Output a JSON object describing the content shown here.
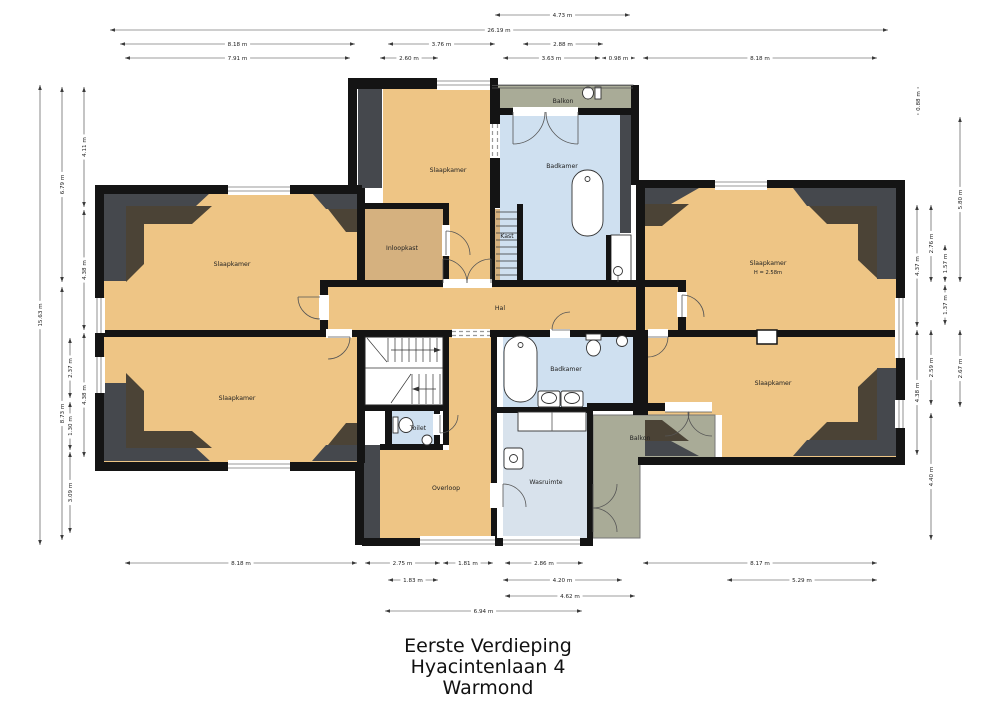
{
  "title": {
    "line1": "Eerste Verdieping",
    "line2": "Hyacintenlaan 4",
    "line3": "Warmond"
  },
  "rooms": [
    {
      "id": "slaapkamer-tl",
      "label": "Slaapkamer",
      "x": 232,
      "y": 266
    },
    {
      "id": "slaapkamer-bl",
      "label": "Slaapkamer",
      "x": 237,
      "y": 400
    },
    {
      "id": "slaapkamer-tc",
      "label": "Slaapkamer",
      "x": 448,
      "y": 172
    },
    {
      "id": "inloopkast",
      "label": "Inloopkast",
      "x": 402,
      "y": 250
    },
    {
      "id": "kast",
      "label": "Kast",
      "x": 507,
      "y": 238
    },
    {
      "id": "badkamer-top",
      "label": "Badkamer",
      "x": 562,
      "y": 168
    },
    {
      "id": "balkon-top",
      "label": "Balkon",
      "x": 563,
      "y": 103
    },
    {
      "id": "slaapkamer-tr",
      "label": "Slaapkamer",
      "x": 768,
      "y": 265,
      "sub": "H = 2.58m"
    },
    {
      "id": "slaapkamer-br",
      "label": "Slaapkamer",
      "x": 773,
      "y": 385
    },
    {
      "id": "hal",
      "label": "Hal",
      "x": 500,
      "y": 310
    },
    {
      "id": "toilet",
      "label": "Toilet",
      "x": 418,
      "y": 430
    },
    {
      "id": "overloop",
      "label": "Overloop",
      "x": 446,
      "y": 490
    },
    {
      "id": "badkamer-bottom",
      "label": "Badkamer",
      "x": 566,
      "y": 371
    },
    {
      "id": "wasruimte",
      "label": "Wasruimte",
      "x": 546,
      "y": 484
    },
    {
      "id": "balkon-bottom",
      "label": "Balkon",
      "x": 640,
      "y": 440
    }
  ],
  "dimensions": {
    "horizontal": [
      {
        "x1": 495,
        "x2": 630,
        "y": 15,
        "label": "4.73 m"
      },
      {
        "x1": 110,
        "x2": 888,
        "y": 30,
        "label": "26.19 m"
      },
      {
        "x1": 120,
        "x2": 355,
        "y": 44,
        "label": "8.18 m"
      },
      {
        "x1": 388,
        "x2": 495,
        "y": 44,
        "label": "3.76 m"
      },
      {
        "x1": 523,
        "x2": 603,
        "y": 44,
        "label": "2.88 m"
      },
      {
        "x1": 125,
        "x2": 350,
        "y": 58,
        "label": "7.91 m"
      },
      {
        "x1": 380,
        "x2": 438,
        "y": 58,
        "label": "2.60 m"
      },
      {
        "x1": 503,
        "x2": 600,
        "y": 58,
        "label": "3.63 m"
      },
      {
        "x1": 602,
        "x2": 635,
        "y": 58,
        "label": "0.98 m"
      },
      {
        "x1": 643,
        "x2": 877,
        "y": 58,
        "label": "8.18 m"
      },
      {
        "x1": 125,
        "x2": 357,
        "y": 563,
        "label": "8.18 m"
      },
      {
        "x1": 365,
        "x2": 440,
        "y": 563,
        "label": "2.75 m"
      },
      {
        "x1": 443,
        "x2": 493,
        "y": 563,
        "label": "1.81 m"
      },
      {
        "x1": 505,
        "x2": 583,
        "y": 563,
        "label": "2.86 m"
      },
      {
        "x1": 643,
        "x2": 877,
        "y": 563,
        "label": "8.17 m"
      },
      {
        "x1": 388,
        "x2": 438,
        "y": 580,
        "label": "1.83 m"
      },
      {
        "x1": 503,
        "x2": 622,
        "y": 580,
        "label": "4.20 m"
      },
      {
        "x1": 727,
        "x2": 877,
        "y": 580,
        "label": "5.29 m"
      },
      {
        "x1": 505,
        "x2": 635,
        "y": 596,
        "label": "4.62 m"
      },
      {
        "x1": 385,
        "x2": 582,
        "y": 611,
        "label": "6.94 m"
      }
    ],
    "vertical": [
      {
        "x": 40,
        "y1": 85,
        "y2": 545,
        "label": "15.63 m"
      },
      {
        "x": 62,
        "y1": 87,
        "y2": 282,
        "label": "6.79 m"
      },
      {
        "x": 62,
        "y1": 287,
        "y2": 540,
        "label": "8.73 m"
      },
      {
        "x": 84,
        "y1": 87,
        "y2": 207,
        "label": "4.11 m"
      },
      {
        "x": 84,
        "y1": 210,
        "y2": 330,
        "label": "4.38 m"
      },
      {
        "x": 70,
        "y1": 338,
        "y2": 398,
        "label": "2.37 m"
      },
      {
        "x": 70,
        "y1": 402,
        "y2": 450,
        "label": "1.30 m"
      },
      {
        "x": 70,
        "y1": 452,
        "y2": 533,
        "label": "3.09 m"
      },
      {
        "x": 84,
        "y1": 333,
        "y2": 457,
        "label": "4.38 m"
      },
      {
        "x": 918,
        "y1": 87,
        "y2": 115,
        "label": "0.88 m"
      },
      {
        "x": 960,
        "y1": 117,
        "y2": 282,
        "label": "5.80 m"
      },
      {
        "x": 917,
        "y1": 205,
        "y2": 327,
        "label": "4.37 m"
      },
      {
        "x": 931,
        "y1": 205,
        "y2": 282,
        "label": "2.76 m"
      },
      {
        "x": 945,
        "y1": 245,
        "y2": 282,
        "label": "1.57 m"
      },
      {
        "x": 945,
        "y1": 285,
        "y2": 325,
        "label": "1.37 m"
      },
      {
        "x": 917,
        "y1": 330,
        "y2": 455,
        "label": "4.38 m"
      },
      {
        "x": 931,
        "y1": 330,
        "y2": 405,
        "label": "2.59 m"
      },
      {
        "x": 960,
        "y1": 330,
        "y2": 407,
        "label": "2.67 m"
      },
      {
        "x": 931,
        "y1": 413,
        "y2": 540,
        "label": "4.40 m"
      }
    ]
  },
  "colors": {
    "floor_main": "#eec585",
    "floor_closet": "#d5b17f",
    "floor_wet": "#cfe0f0",
    "floor_laundry": "#d8e2ec",
    "balcony": "#a9ab97",
    "wall": "#141414",
    "slope_dark": "#45484d",
    "slope_brown": "#4b4336",
    "dim_line": "#3a3a3a"
  }
}
